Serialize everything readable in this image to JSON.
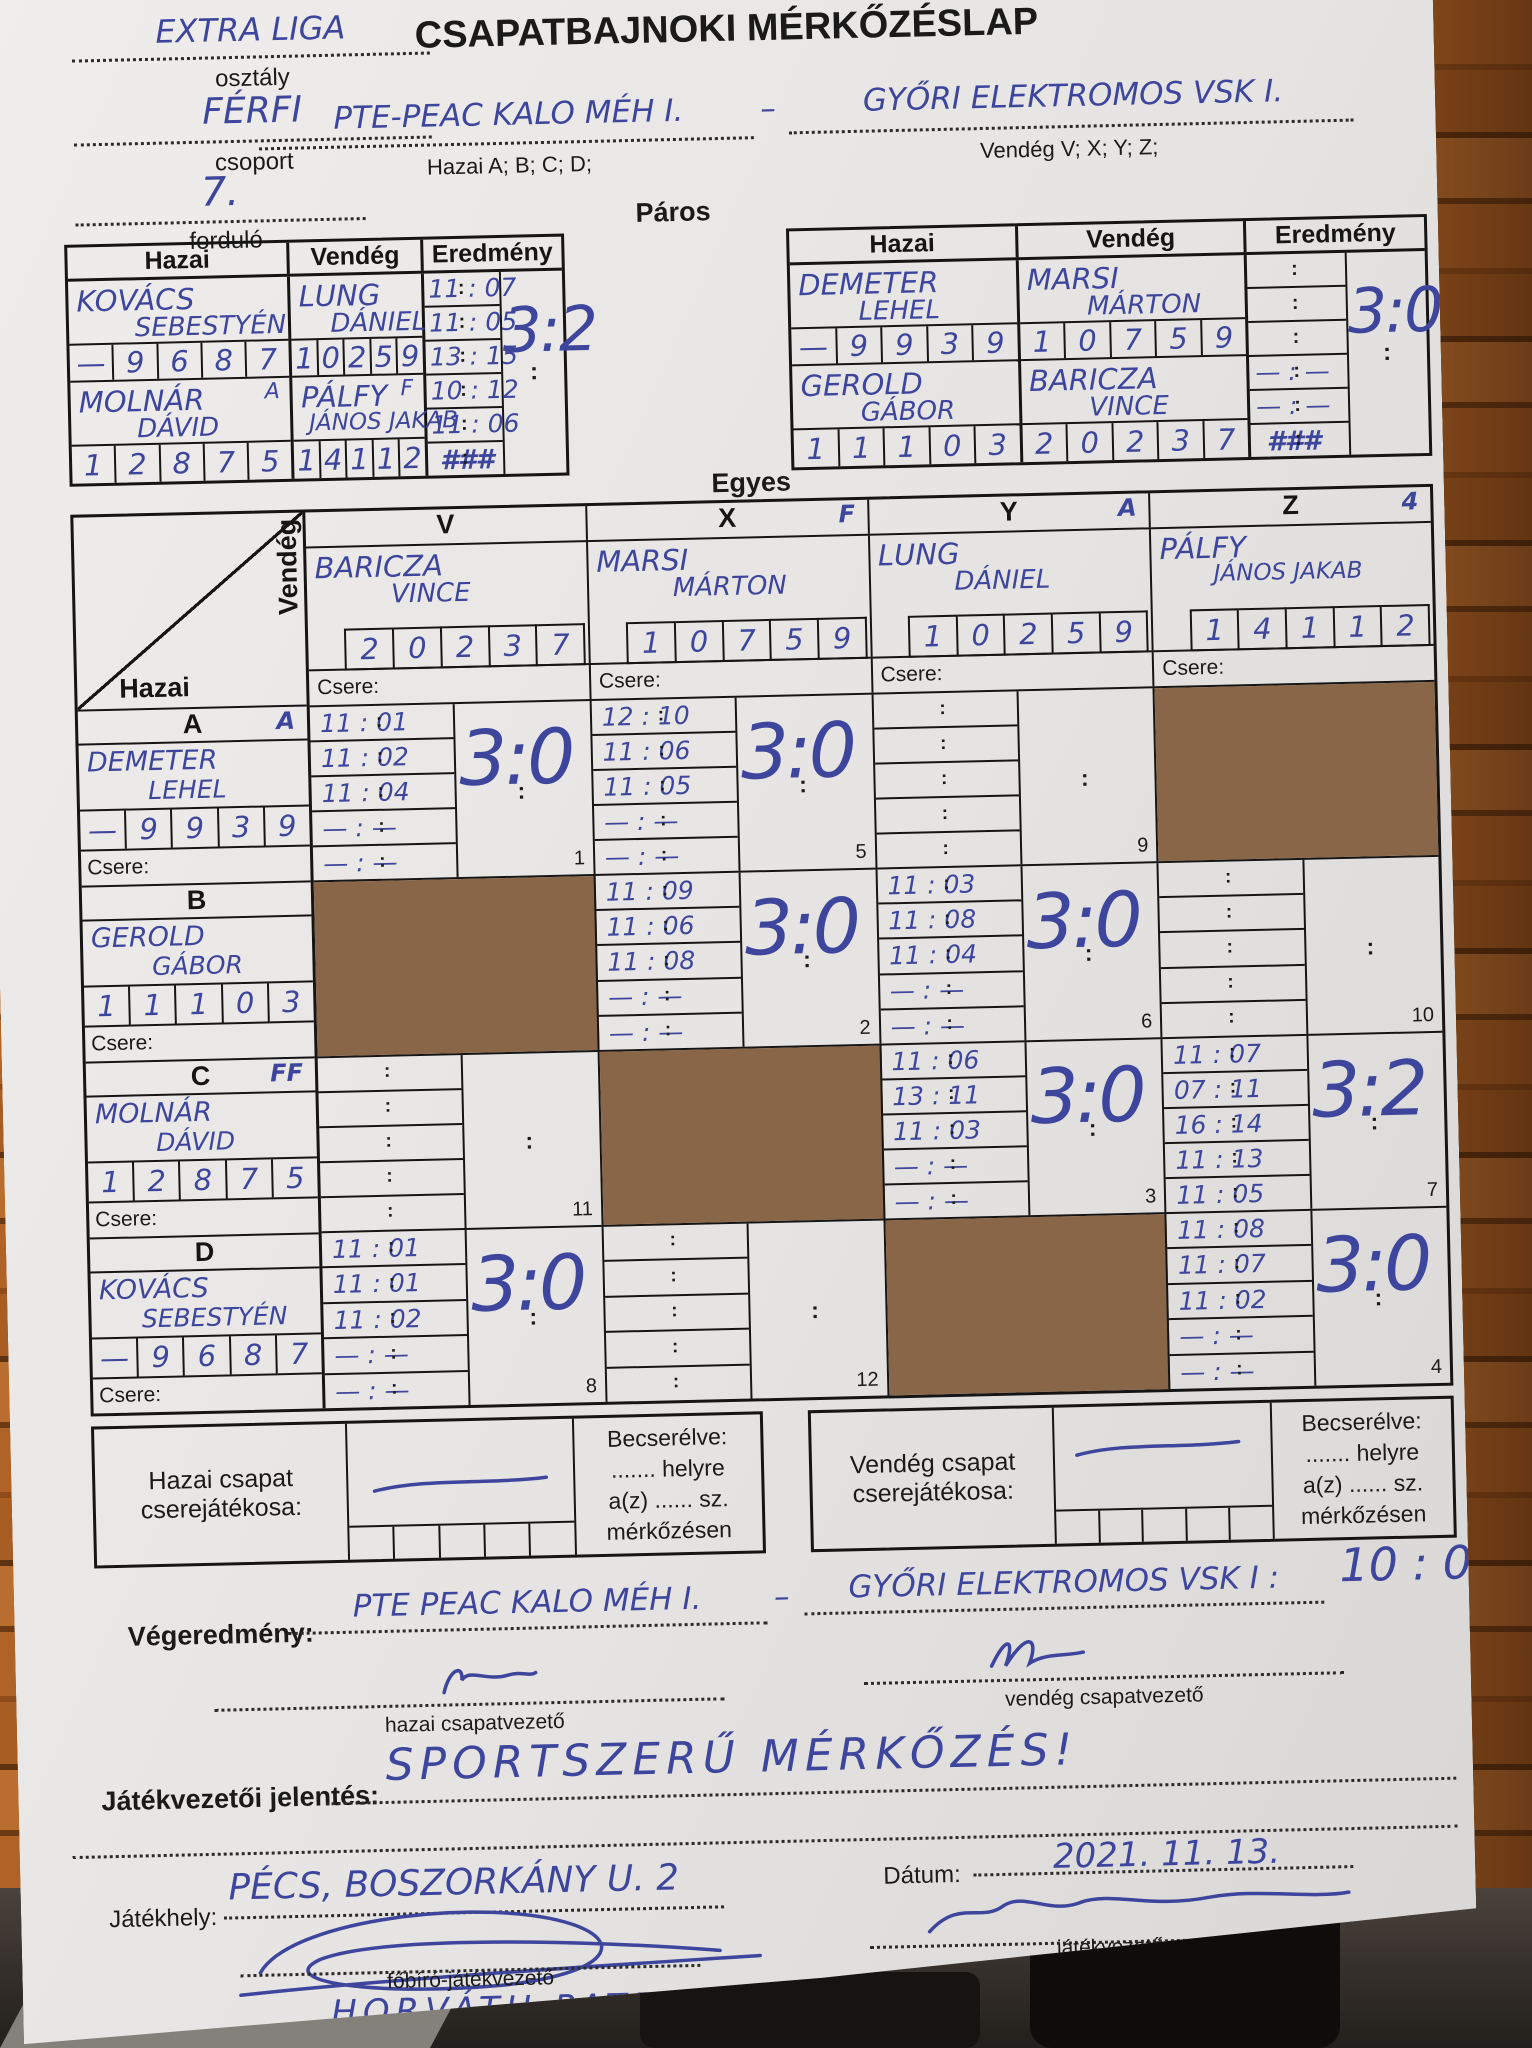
{
  "header": {
    "liga": "EXTRA LIGA",
    "class_label": "osztály",
    "class_value": "FÉRFI",
    "group_label": "csoport",
    "group_value": "7.",
    "round_label": "forduló",
    "title": "CSAPATBAJNOKI MÉRKŐZÉSLAP",
    "home_team": "PTE-PEAC KALO MÉH I.",
    "sep": "–",
    "away_team": "GYŐRI ELEKTROMOS VSK I.",
    "home_hint": "Hazai A; B; C; D;",
    "away_hint": "Vendég V; X; Y; Z;",
    "paros_label": "Páros",
    "egyes_label": "Egyes"
  },
  "paros": {
    "headers": [
      "Hazai",
      "Vendég",
      "Eredmény"
    ],
    "left": {
      "h1_last": "KOVÁCS",
      "h1_first": "SEBESTYÉN",
      "h1_lic": [
        "—",
        "9",
        "6",
        "8",
        "7"
      ],
      "h2_last": "MOLNÁR",
      "h2_mark": "A",
      "h2_first": "DÁVID",
      "h2_lic": [
        "1",
        "2",
        "8",
        "7",
        "5"
      ],
      "v1_last": "LUNG",
      "v1_first": "DÁNIEL",
      "v1_lic": [
        "1",
        "0",
        "2",
        "5",
        "9"
      ],
      "v2_last": "PÁLFY",
      "v2_mark": "F",
      "v2_first": "JÁNOS JAKAB",
      "v2_lic": [
        "1",
        "4",
        "1",
        "1",
        "2"
      ],
      "scores": [
        "11 : 07",
        "11 : 05",
        "13 : 15",
        "10 : 12",
        "11 : 06"
      ],
      "hash": "###",
      "total": "3:2"
    },
    "right": {
      "h1_last": "DEMETER",
      "h1_first": "LEHEL",
      "h1_lic": [
        "—",
        "9",
        "9",
        "3",
        "9"
      ],
      "h2_last": "GEROLD",
      "h2_first": "GÁBOR",
      "h2_lic": [
        "1",
        "1",
        "1",
        "0",
        "3"
      ],
      "v1_last": "MARSI",
      "v1_first": "MÁRTON",
      "v1_lic": [
        "1",
        "0",
        "7",
        "5",
        "9"
      ],
      "v2_last": "BARICZA",
      "v2_first": "VINCE",
      "v2_lic": [
        "2",
        "0",
        "2",
        "3",
        "7"
      ],
      "scores": [
        "",
        "",
        "",
        "— : —",
        "— : —"
      ],
      "hash": "###",
      "total": "3:0"
    }
  },
  "egyes": {
    "vendeg_label": "Vendég",
    "hazai_label": "Hazai",
    "csere_label": "Csere:",
    "columns": [
      {
        "letter": "V",
        "mark": "",
        "last": "BARICZA",
        "first": "VINCE",
        "lic": [
          "2",
          "0",
          "2",
          "3",
          "7"
        ]
      },
      {
        "letter": "X",
        "mark": "F",
        "last": "MARSI",
        "first": "MÁRTON",
        "lic": [
          "1",
          "0",
          "7",
          "5",
          "9"
        ]
      },
      {
        "letter": "Y",
        "mark": "A",
        "last": "LUNG",
        "first": "DÁNIEL",
        "lic": [
          "1",
          "0",
          "2",
          "5",
          "9"
        ]
      },
      {
        "letter": "Z",
        "mark": "4",
        "last": "PÁLFY",
        "first": "JÁNOS JAKAB",
        "lic": [
          "1",
          "4",
          "1",
          "1",
          "2"
        ]
      }
    ],
    "rows": [
      {
        "letter": "A",
        "mark": "A",
        "last": "DEMETER",
        "first": "LEHEL",
        "lic": [
          "—",
          "9",
          "9",
          "3",
          "9"
        ],
        "cells": [
          {
            "scores": [
              "11 : 01",
              "11 : 02",
              "11 : 04",
              "— : —",
              "— : —"
            ],
            "total": "3:0",
            "match": "1"
          },
          {
            "scores": [
              "12 : 10",
              "11 : 06",
              "11 : 05",
              "— : —",
              "— : —"
            ],
            "total": "3:0",
            "match": "5"
          },
          {
            "scores": [
              "",
              "",
              "",
              "",
              ""
            ],
            "total": "",
            "match": "9"
          },
          {
            "blocked": true
          }
        ]
      },
      {
        "letter": "B",
        "mark": "",
        "last": "GEROLD",
        "first": "GÁBOR",
        "lic": [
          "1",
          "1",
          "1",
          "0",
          "3"
        ],
        "cells": [
          {
            "blocked": true
          },
          {
            "scores": [
              "11 : 09",
              "11 : 06",
              "11 : 08",
              "— : —",
              "— : —"
            ],
            "total": "3:0",
            "match": "2"
          },
          {
            "scores": [
              "11 : 03",
              "11 : 08",
              "11 : 04",
              "— : —",
              "— : —"
            ],
            "total": "3:0",
            "match": "6"
          },
          {
            "scores": [
              "",
              "",
              "",
              "",
              ""
            ],
            "total": "",
            "match": "10"
          }
        ]
      },
      {
        "letter": "C",
        "mark": "FF",
        "last": "MOLNÁR",
        "first": "DÁVID",
        "lic": [
          "1",
          "2",
          "8",
          "7",
          "5"
        ],
        "cells": [
          {
            "scores": [
              "",
              "",
              "",
              "",
              ""
            ],
            "total": "",
            "match": "11"
          },
          {
            "blocked": true
          },
          {
            "scores": [
              "11 : 06",
              "13 : 11",
              "11 : 03",
              "— : —",
              "— : —"
            ],
            "total": "3:0",
            "match": "3"
          },
          {
            "scores": [
              "11 : 07",
              "07 : 11",
              "16 : 14",
              "11 : 13",
              "11 : 05"
            ],
            "total": "3:2",
            "match": "7"
          }
        ]
      },
      {
        "letter": "D",
        "mark": "",
        "last": "KOVÁCS",
        "first": "SEBESTYÉN",
        "lic": [
          "—",
          "9",
          "6",
          "8",
          "7"
        ],
        "cells": [
          {
            "scores": [
              "11 : 01",
              "11 : 01",
              "11 : 02",
              "— : —",
              "— : —"
            ],
            "total": "3:0",
            "match": "8"
          },
          {
            "scores": [
              "",
              "",
              "",
              "",
              ""
            ],
            "total": "",
            "match": "12"
          },
          {
            "blocked": true
          },
          {
            "scores": [
              "11 : 08",
              "11 : 07",
              "11 : 02",
              "— : —",
              "— : —"
            ],
            "total": "3:0",
            "match": "4"
          }
        ]
      }
    ]
  },
  "subs": {
    "home_label": "Hazai csapat cserejátékosa:",
    "away_label": "Vendég csapat cserejátékosa:",
    "line1": "Becserélve:",
    "line2": "....... helyre",
    "line3": "a(z) ...... sz.",
    "line4": "mérkőzésen"
  },
  "footer": {
    "vegeredmeny_label": "Végeredmény:",
    "home": "PTE PEAC KALO MÉH I.",
    "sep": "–",
    "away": "GYŐRI ELEKTROMOS VSK I :",
    "score": "10 : 0",
    "home_captain_label": "hazai csapatvezető",
    "away_captain_label": "vendég csapatvezető",
    "report_label": "Játékvezetői jelentés:",
    "report_value": "SPORTSZERŰ MÉRKŐZÉS!",
    "venue_label": "Játékhely:",
    "venue_value": "PÉCS, BOSZORKÁNY U. 2",
    "date_label": "Dátum:",
    "date_value": "2021. 11. 13.",
    "chief_ref_label": "főbíró-játékvezető",
    "chief_ref_name": "HORVÁTH PATRIK",
    "ref_label": "játékvezető",
    "ref_name": "CSIZMADIA KÁROLY"
  },
  "colors": {
    "ink": "#3d459c",
    "blocked_cell": "#8a6648",
    "paper": "#e9e7e5"
  }
}
